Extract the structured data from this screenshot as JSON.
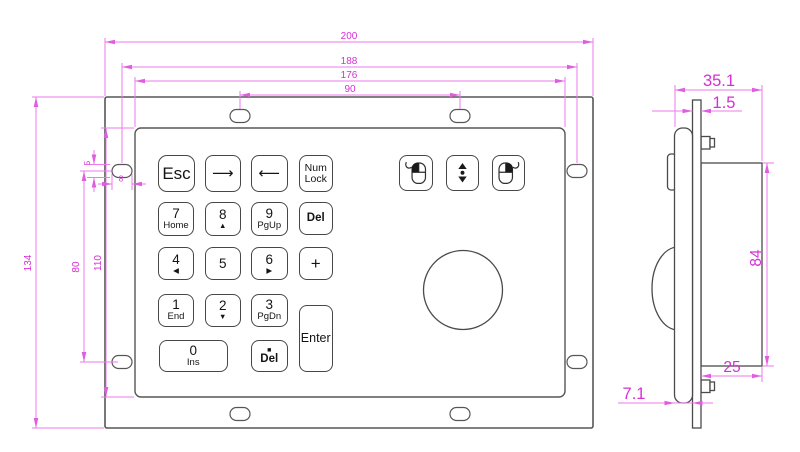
{
  "drawing": {
    "front_view": {
      "dimensions": {
        "total_width": "200",
        "hole_span_width": "188",
        "bezel_width": "176",
        "top_hole_span": "90",
        "total_height": "134",
        "bezel_height": "110",
        "side_hole_span": "80",
        "slot_height": "5",
        "slot_width": "8"
      },
      "keys": [
        {
          "id": "esc",
          "label": "Esc"
        },
        {
          "id": "arrow-right",
          "label": "⟶"
        },
        {
          "id": "arrow-left",
          "label": "⟵"
        },
        {
          "id": "num-lock",
          "label": "Num",
          "sub": "Lock"
        },
        {
          "id": "seven",
          "label": "7",
          "sub": "Home"
        },
        {
          "id": "eight",
          "label": "8",
          "sub": "▲"
        },
        {
          "id": "nine",
          "label": "9",
          "sub": "PgUp"
        },
        {
          "id": "del-top",
          "label": "Del"
        },
        {
          "id": "four",
          "label": "4",
          "sub": "◀"
        },
        {
          "id": "five",
          "label": "5"
        },
        {
          "id": "six",
          "label": "6",
          "sub": "▶"
        },
        {
          "id": "plus",
          "label": "+"
        },
        {
          "id": "one",
          "label": "1",
          "sub": "End"
        },
        {
          "id": "two",
          "label": "2",
          "sub": "▼"
        },
        {
          "id": "three",
          "label": "3",
          "sub": "PgDn"
        },
        {
          "id": "zero",
          "label": "0",
          "sub": "Ins"
        },
        {
          "id": "del-bottom",
          "label": "■",
          "sub": "Del"
        },
        {
          "id": "enter",
          "label": "Enter"
        }
      ],
      "mouse_keys": [
        {
          "icon": "left-click-mouse-icon"
        },
        {
          "icon": "scroll-wheel-icon"
        },
        {
          "icon": "right-click-mouse-icon"
        }
      ]
    },
    "side_view": {
      "dimensions": {
        "total_depth": "35.1",
        "panel_thickness": "1.5",
        "case_height": "84",
        "case_depth": "25",
        "bezel_thickness": "7.1"
      }
    },
    "colors": {
      "dimension_text": "#d62fd6",
      "dimension_line": "#ee7aee",
      "outline": "#4d4d4d",
      "key_text": "#141414",
      "background": "#ffffff"
    }
  }
}
